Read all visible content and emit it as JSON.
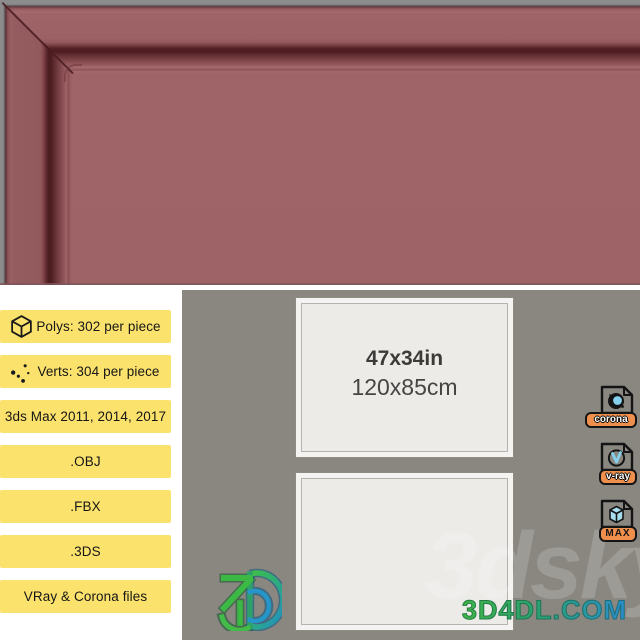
{
  "render": {
    "subject": "picture-frame corner close-up wireframe render",
    "frame_color": "#9d6367",
    "background_gray": "#8b8c8b"
  },
  "specs": {
    "items": [
      {
        "icon": "cube-icon",
        "label": "Polys: 302 per piece"
      },
      {
        "icon": "vertices-icon",
        "label": "Verts: 304 per piece"
      },
      {
        "icon": "",
        "label": "3ds Max 2011, 2014, 2017"
      },
      {
        "icon": "",
        "label": ".OBJ"
      },
      {
        "icon": "",
        "label": ".FBX"
      },
      {
        "icon": "",
        "label": ".3DS"
      },
      {
        "icon": "",
        "label": "VRay & Corona files"
      }
    ]
  },
  "preview": {
    "size_in": "47x34in",
    "size_cm": "120x85cm"
  },
  "file_formats": {
    "items": [
      {
        "name": "corona",
        "label": "corona"
      },
      {
        "name": "vray",
        "label": "v-ray"
      },
      {
        "name": "max",
        "label": "MAX"
      }
    ]
  },
  "watermark": {
    "site": "3D4DL.COM",
    "community": "3dsky"
  },
  "colors": {
    "badge_yellow": "#fbe26d",
    "panel_gray": "#8a8781",
    "accent_orange": "#ef8f4d",
    "logo_green": "#3fb547",
    "logo_blue": "#2a8fd0"
  }
}
